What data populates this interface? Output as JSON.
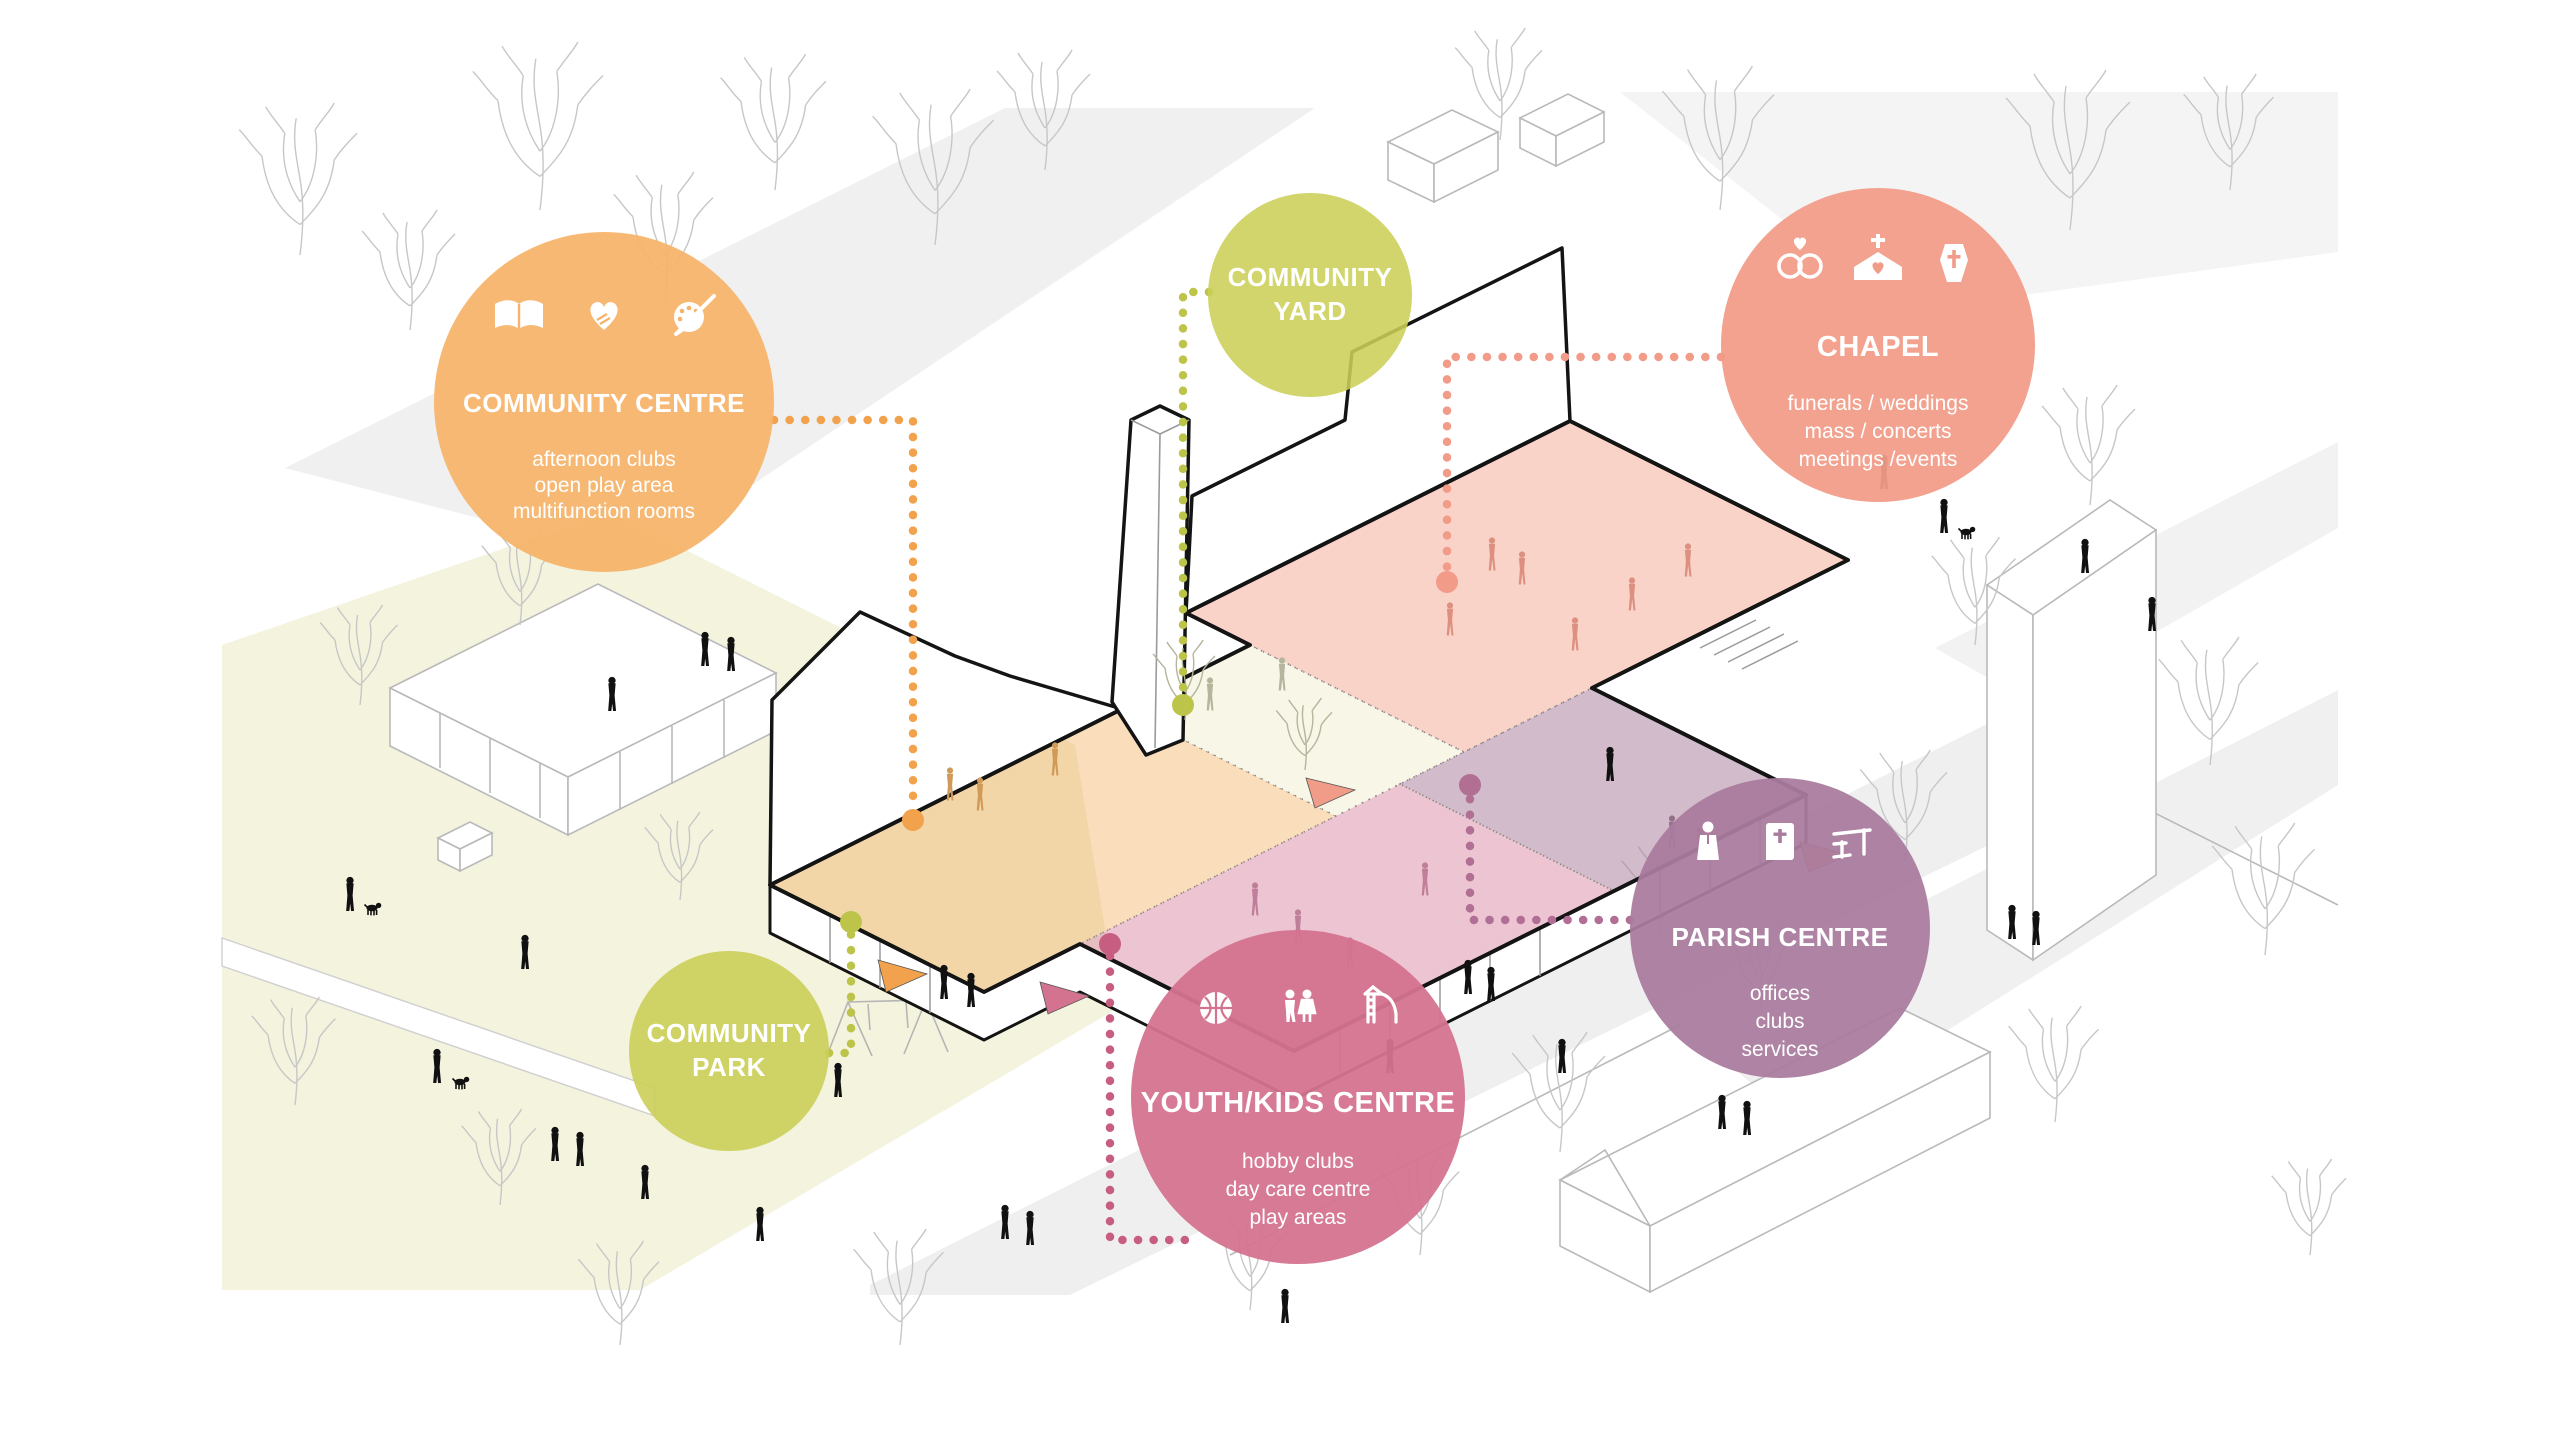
{
  "scene": {
    "background": "#ffffff",
    "park_fill": "#f4f3de",
    "road_fill": "#f0f0f0",
    "outline_color": "#141414",
    "tree_color": "#c7c7c7",
    "figure_color": "#111111",
    "figure_tints": {
      "orange": "#d09a58",
      "salmon": "#dd9080",
      "pink": "#c07f98",
      "purple": "#93708c",
      "yard": "#b5b59d"
    }
  },
  "zones": [
    {
      "id": "community-centre-zone",
      "color": "#F2A94F"
    },
    {
      "id": "community-yard-zone",
      "color": "#F7F6E7"
    },
    {
      "id": "chapel-zone",
      "color": "#F29B85"
    },
    {
      "id": "youth-kids-zone",
      "color": "#D884A0"
    },
    {
      "id": "parish-zone",
      "color": "#A87F9C"
    }
  ],
  "leaders": [
    {
      "id": "community-centre-leader",
      "color": "#F2A24C"
    },
    {
      "id": "community-yard-leader",
      "color": "#BCC54A"
    },
    {
      "id": "chapel-leader",
      "color": "#F29B88"
    },
    {
      "id": "parish-leader",
      "color": "#B06F93"
    },
    {
      "id": "youth-kids-leader",
      "color": "#C75E82"
    },
    {
      "id": "community-park-leader",
      "color": "#BCC54A"
    }
  ],
  "bubbles": [
    {
      "id": "community-centre",
      "color": "#F5B46A",
      "title_lines": [
        "COMMUNITY CENTRE"
      ],
      "details": [
        "afternoon  clubs",
        "open play area",
        "multifunction rooms"
      ],
      "icons": [
        "open-book",
        "hands-heart",
        "paint-palette"
      ]
    },
    {
      "id": "community-yard",
      "color": "#CBCF58",
      "title_lines": [
        "COMMUNITY",
        "YARD"
      ],
      "details": [],
      "icons": []
    },
    {
      "id": "chapel",
      "color": "#F19C88",
      "title_lines": [
        "CHAPEL"
      ],
      "details": [
        "funerals / weddings",
        "mass / concerts",
        "meetings /events"
      ],
      "icons": [
        "wedding-rings",
        "church",
        "coffin"
      ]
    },
    {
      "id": "parish-centre",
      "color": "#A97B9D",
      "title_lines": [
        "PARISH CENTRE"
      ],
      "details": [
        "offices",
        "clubs",
        "services"
      ],
      "icons": [
        "priest",
        "bible",
        "office-desk"
      ]
    },
    {
      "id": "youth-kids-centre",
      "color": "#D4738F",
      "title_lines": [
        "YOUTH/KIDS CENTRE"
      ],
      "details": [
        "hobby clubs",
        "day care centre",
        "play areas"
      ],
      "icons": [
        "basketball",
        "children",
        "playground-slide"
      ]
    },
    {
      "id": "community-park",
      "color": "#CBCF58",
      "title_lines": [
        "COMMUNITY",
        "PARK"
      ],
      "details": [],
      "icons": []
    }
  ]
}
